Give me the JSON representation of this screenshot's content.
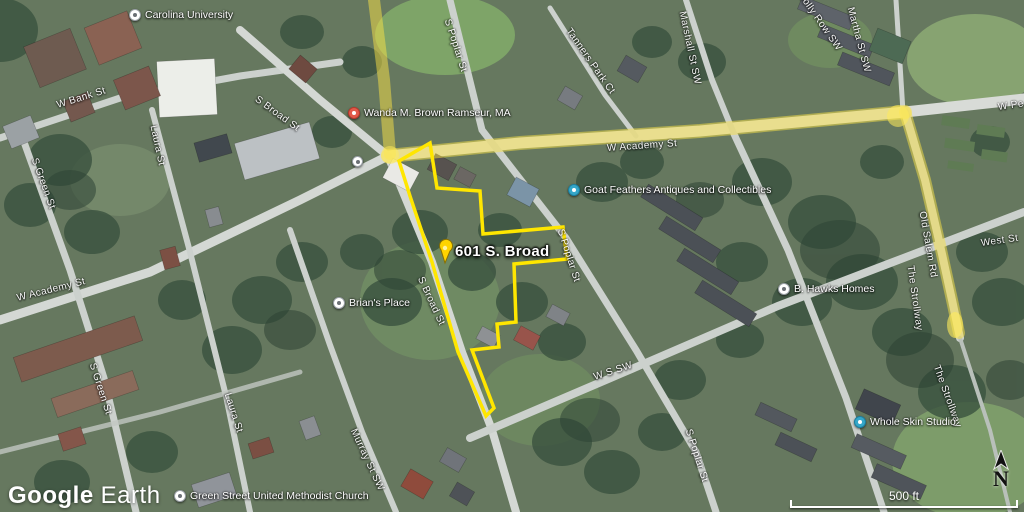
{
  "app": {
    "logo_google": "Google",
    "logo_earth": "Earth"
  },
  "map_controls": {
    "scale_text": "500 ft",
    "north_label": "N"
  },
  "parcel": {
    "label": "601 S. Broad",
    "outline_color": "#ffe600",
    "pin_color": "#ffd400"
  },
  "route": {
    "highlight_color": "#f5e063"
  },
  "pois": [
    {
      "name": "Carolina University",
      "marker": "white-circle"
    },
    {
      "name": "Wanda M. Brown Ramseur, MA",
      "marker": "red-circle"
    },
    {
      "name": "Goat Feathers Antiques and Collectibles",
      "marker": "teal-circle"
    },
    {
      "name": "Brian's Place",
      "marker": "white-circle"
    },
    {
      "name": "B. Hawks Homes",
      "marker": "white-circle"
    },
    {
      "name": "Whole Skin Studio",
      "marker": "teal-circle"
    },
    {
      "name": "Green Street United Methodist Church",
      "marker": "white-circle"
    }
  ],
  "street_labels": [
    {
      "text": "W Bank St"
    },
    {
      "text": "S Green St"
    },
    {
      "text": "Laura St"
    },
    {
      "text": "S Broad St"
    },
    {
      "text": "W Academy St"
    },
    {
      "text": "W Academy St"
    },
    {
      "text": "S Poplar St"
    },
    {
      "text": "Tanners Park Ct"
    },
    {
      "text": "Marshall St SW"
    },
    {
      "text": "Holly Row SW"
    },
    {
      "text": "Martha St SW"
    },
    {
      "text": "W Pe"
    },
    {
      "text": "S Broad St"
    },
    {
      "text": "S Poplar St"
    },
    {
      "text": "S Green St"
    },
    {
      "text": "Laura St"
    },
    {
      "text": "Murray St SW"
    },
    {
      "text": "W S SW"
    },
    {
      "text": "S Poplar St"
    },
    {
      "text": "Old Salem Rd"
    },
    {
      "text": "The Strollway"
    },
    {
      "text": "The Strollway"
    },
    {
      "text": "West St"
    }
  ],
  "colors": {
    "poi_red": "#e25a4a",
    "poi_teal": "#35a7c9",
    "scale_white": "#ffffff"
  }
}
